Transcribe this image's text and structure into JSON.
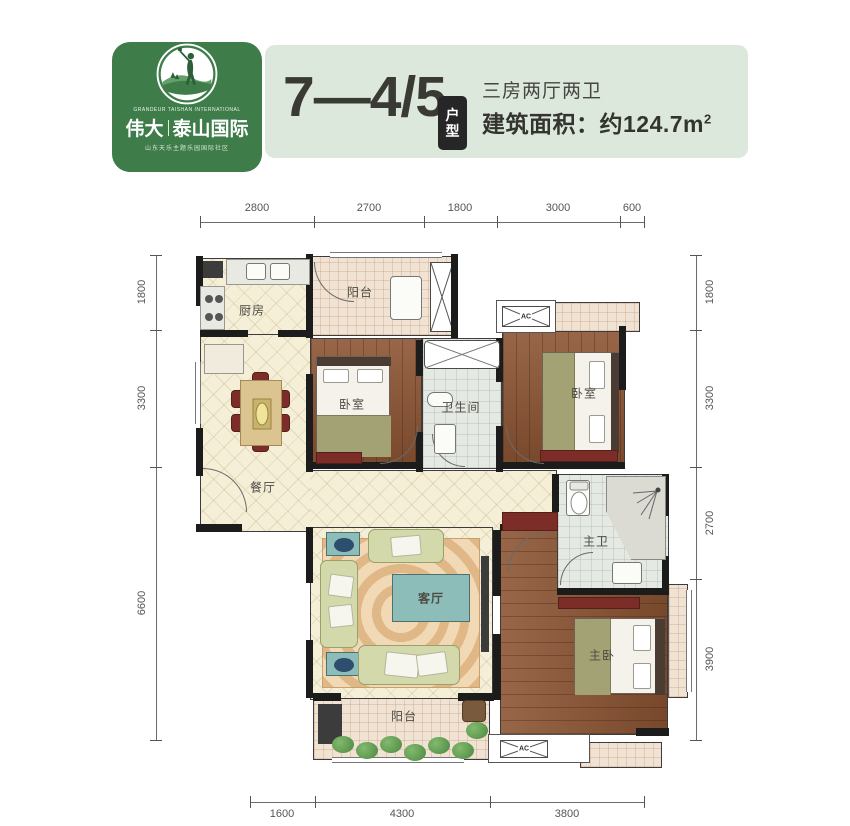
{
  "header": {
    "logo": {
      "english_line": "GRANDEUR TAISHAN INTERNATIONAL",
      "brand_left": "伟大",
      "brand_right": "泰山国际",
      "tagline": "山东天乐主题乐园国际社区",
      "bg_color": "#3e7c4a"
    },
    "banner": {
      "unit_code": "7—4/5",
      "badge_top": "户",
      "badge_bottom": "型",
      "spec_line": "三房两厅两卫",
      "area_line": "建筑面积：约124.7m",
      "area_sup": "2",
      "bg_color": "#dde8dd"
    }
  },
  "plan": {
    "ac_label": "AC",
    "rooms": {
      "kitchen": "厨房",
      "balcony_top": "阳台",
      "bedroom_left": "卧室",
      "bathroom": "卫生间",
      "bedroom_right": "卧室",
      "dining": "餐厅",
      "master_bath": "主卫",
      "living": "客厅",
      "master_bedroom": "主卧",
      "balcony_bottom": "阳台"
    },
    "dimensions": {
      "top": [
        "2800",
        "2700",
        "1800",
        "3000",
        "600"
      ],
      "left": [
        "1800",
        "3300",
        "6600"
      ],
      "right": [
        "1800",
        "3300",
        "2700",
        "3900"
      ],
      "bottom": [
        "1600",
        "4300",
        "3800"
      ]
    }
  }
}
